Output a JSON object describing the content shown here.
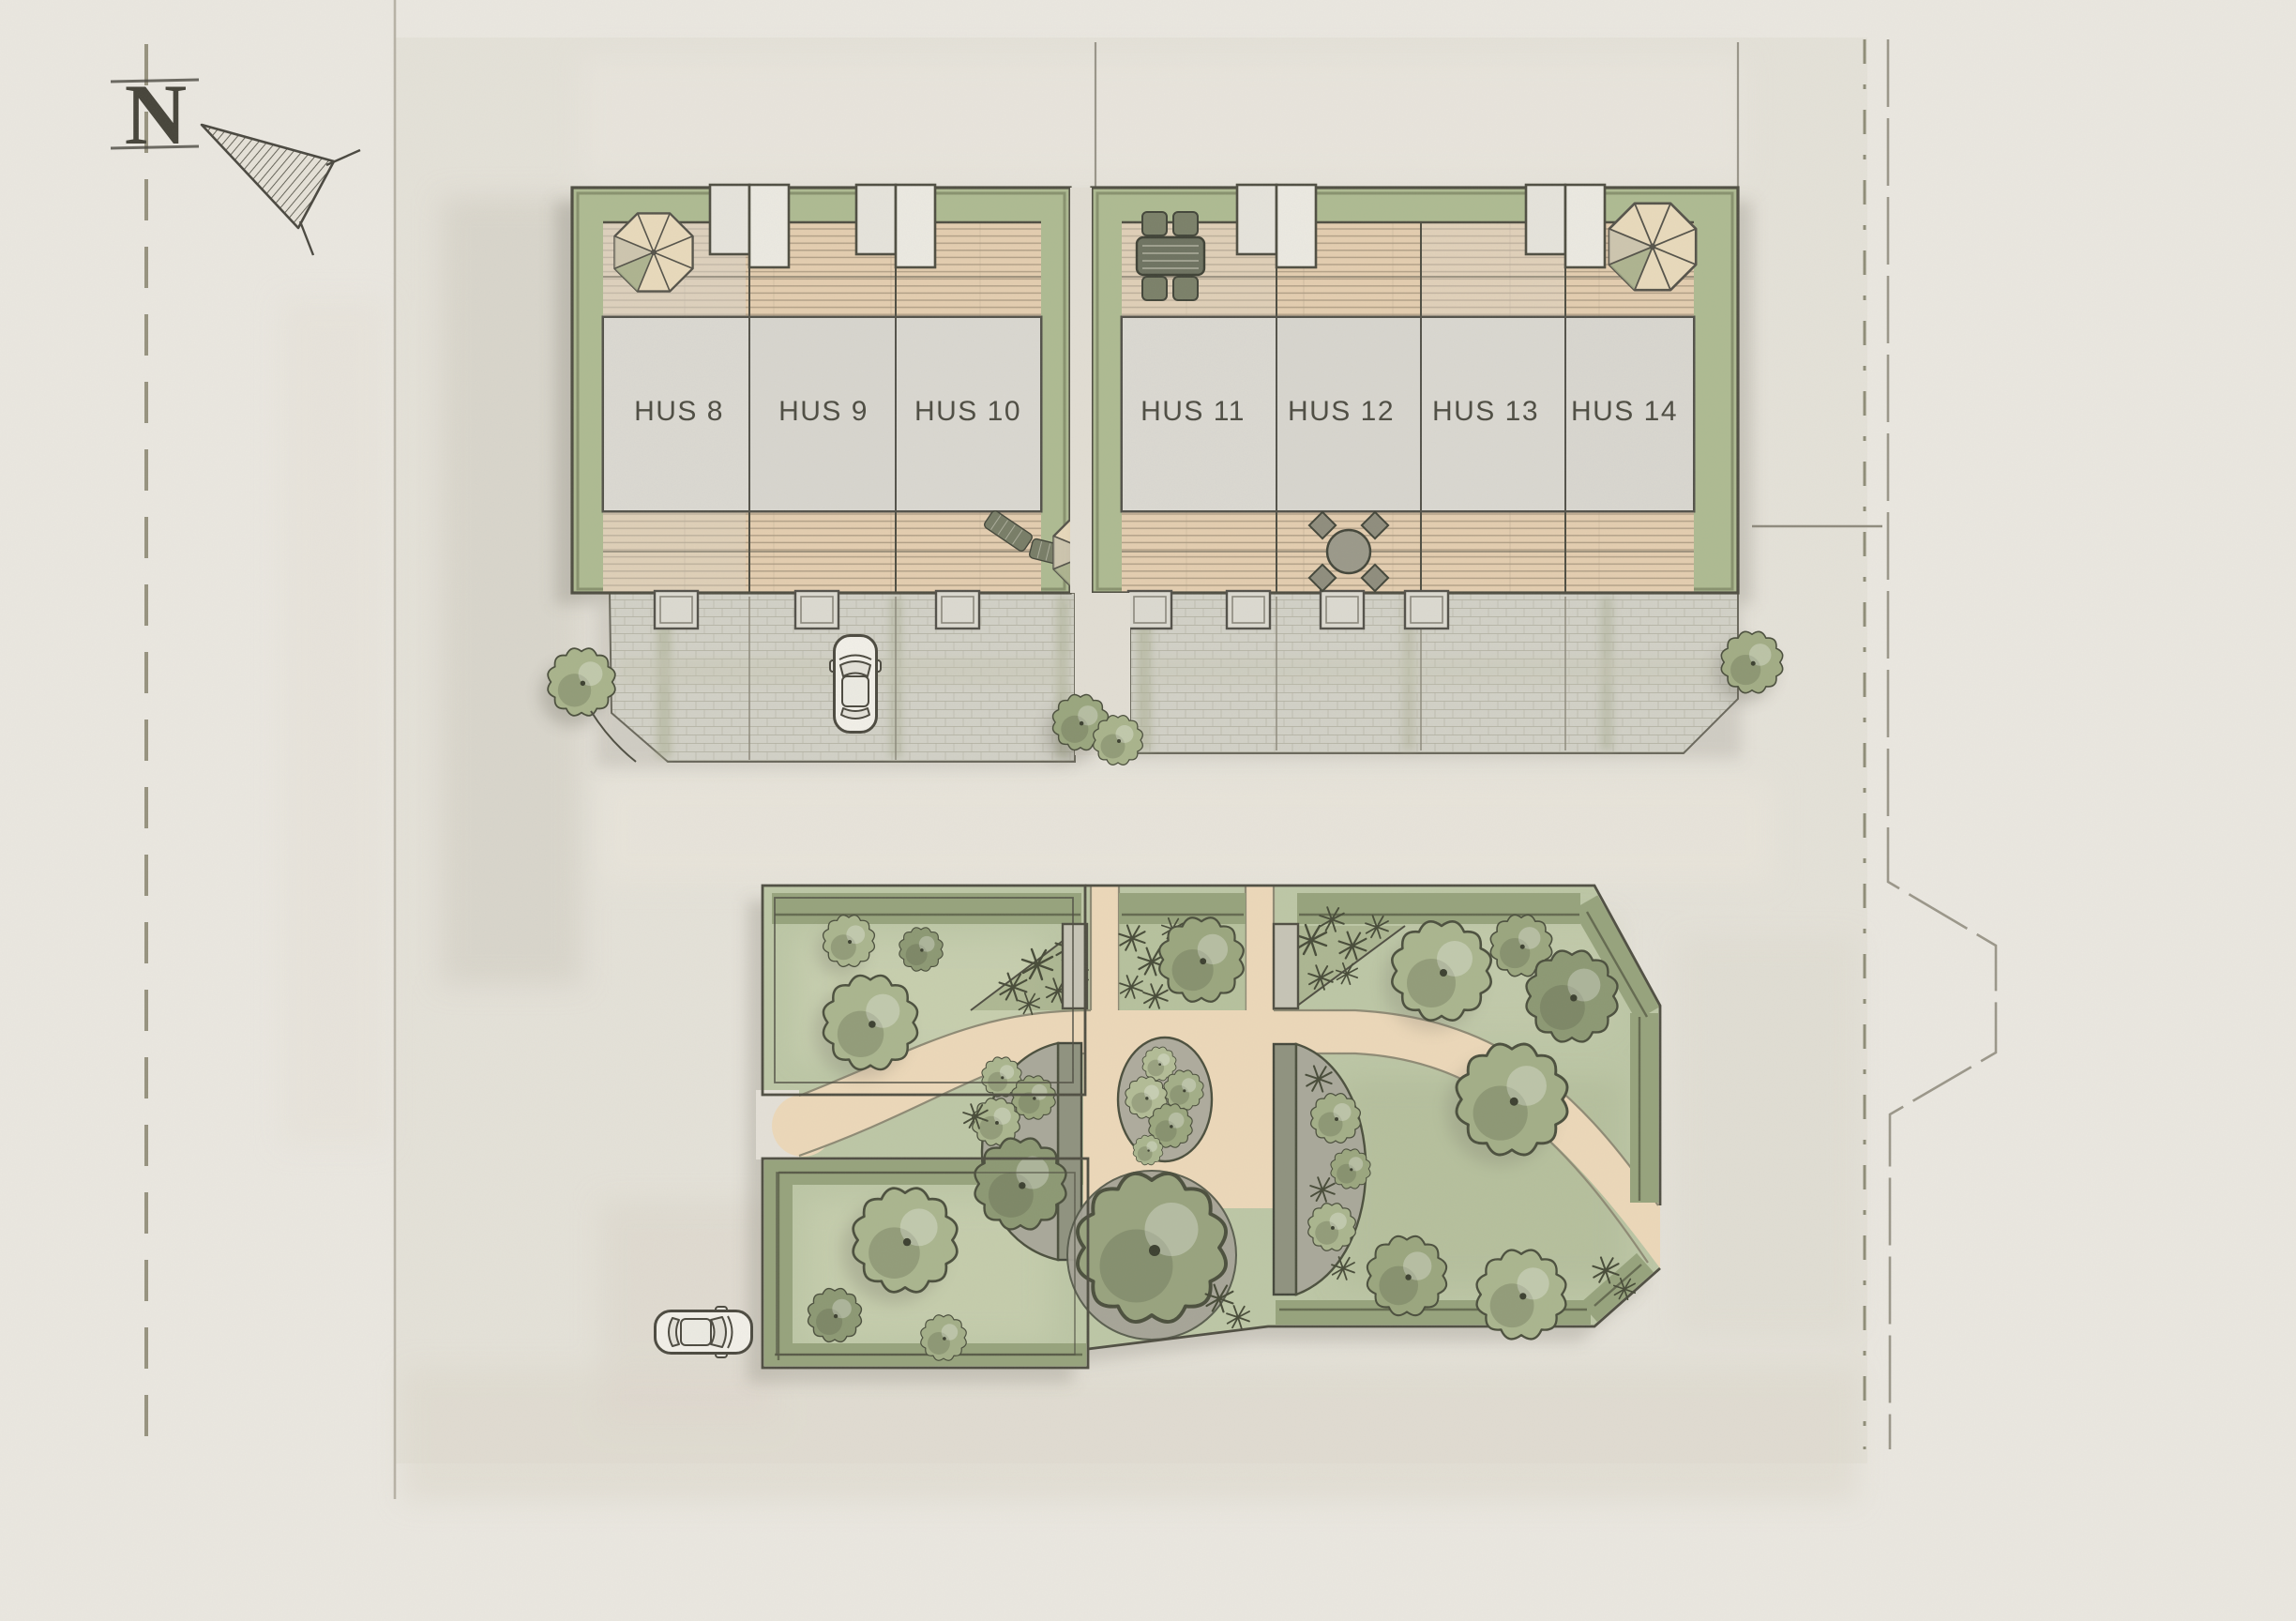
{
  "plan": {
    "title": "Sketch site plan with row houses HUS 8-14 and common garden",
    "north_label": "N",
    "houses": [
      {
        "label": "HUS 8"
      },
      {
        "label": "HUS 9"
      },
      {
        "label": "HUS 10"
      },
      {
        "label": "HUS 11"
      },
      {
        "label": "HUS 12"
      },
      {
        "label": "HUS 13"
      },
      {
        "label": "HUS 14"
      }
    ]
  },
  "colors": {
    "paper": "#ebe8e1",
    "lot_wash": "#e4e0d7",
    "house_grey": "#d9d7d0",
    "deck_tan": "#e4ceb0",
    "hedge_green": "#aebb92",
    "lawn_green": "#bdc7a6",
    "path_tan": "#ecd8b9",
    "paving_grey": "#d2d1c7",
    "ink": "#4f4e42"
  }
}
